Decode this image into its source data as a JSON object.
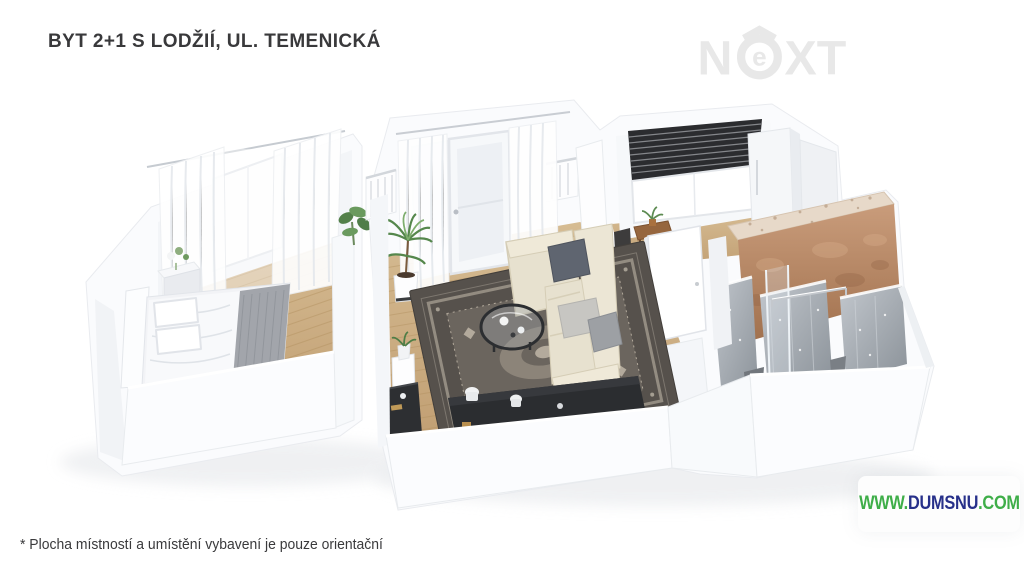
{
  "page": {
    "width": 1024,
    "height": 575,
    "background_color": "#ffffff"
  },
  "header": {
    "title": "BYT 2+1 S LODŽIÍ, UL. TEMENICKÁ",
    "title_color": "#39393b"
  },
  "brand_logo": {
    "name": "NEXT",
    "part_n": "N",
    "part_e": "e",
    "part_xt": "XT",
    "color": "#e8e8e8"
  },
  "watermark": {
    "prefix": "WWW.",
    "domain": "DUMSNU",
    "suffix": ".COM",
    "prefix_color": "#3fae49",
    "domain_color": "#27308a",
    "suffix_color": "#3fae49"
  },
  "footnote": {
    "text": "* Plocha místností a umístění vybavení je pouze orientační"
  },
  "floorplan": {
    "description": "3D cutaway render of apartment 2+1 with loggia",
    "rooms": [
      "bedroom",
      "living-room",
      "kitchen",
      "hallway",
      "bathroom",
      "loggia"
    ],
    "furniture": [
      "double-bed",
      "nightstand-with-flowers",
      "sheer-curtains",
      "bedroom-window",
      "loggia-railing",
      "balcony-door",
      "palm-plant",
      "area-rug",
      "sectional-sofa",
      "round-coffee-table",
      "plant-stand",
      "tv-sideboard",
      "corner-desk",
      "kitchen-window-blinds",
      "dining-table",
      "dining-chair",
      "kitchen-cabinets",
      "copper-feature-wall",
      "marble-shower-walls",
      "glass-shower",
      "towel-rail"
    ],
    "colors": {
      "walls": "#fafbfd",
      "wall_shadow": "#eef1f4",
      "wood_floor": "#c9a97e",
      "rug": "#56514c",
      "sofa": "#e7e1cf",
      "copper_wall": "#b5876a",
      "marble": "#a6adb4",
      "blinds": "#2b2c2f",
      "sideboard": "#2b2d30"
    }
  }
}
